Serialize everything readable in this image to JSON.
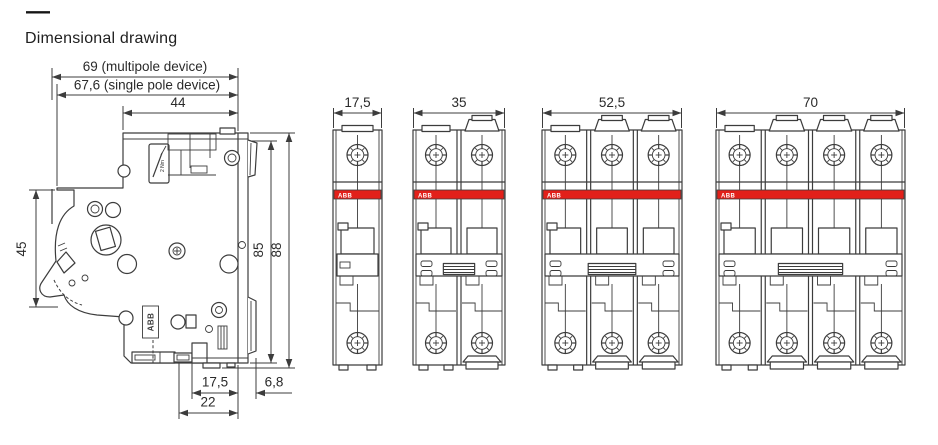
{
  "page": {
    "rule": "—",
    "title": "Dimensional drawing"
  },
  "colors": {
    "brand_red": "#e2201a",
    "line": "#3c3c3c",
    "text": "#2a2a2a"
  },
  "side_view": {
    "brand_vertical": "ABB",
    "torque_label": "2 Nm",
    "dims": {
      "depth_multipole": "69 (multipole device)",
      "depth_single_pole": "67,6 (single pole device)",
      "depth_top": "44",
      "front_height": "45",
      "height_body": "85",
      "height_total": "88",
      "din_recess_width": "17,5",
      "din_clip_depth": "6,8",
      "base_width": "22"
    }
  },
  "front_views": [
    {
      "id": "front-view-1-pole",
      "poles": 1,
      "width_label": "17,5",
      "brand": "ABB"
    },
    {
      "id": "front-view-2-pole",
      "poles": 2,
      "width_label": "35",
      "brand": "ABB"
    },
    {
      "id": "front-view-3-pole",
      "poles": 3,
      "width_label": "52,5",
      "brand": "ABB"
    },
    {
      "id": "front-view-4-pole",
      "poles": 4,
      "width_label": "70",
      "brand": "ABB"
    }
  ]
}
